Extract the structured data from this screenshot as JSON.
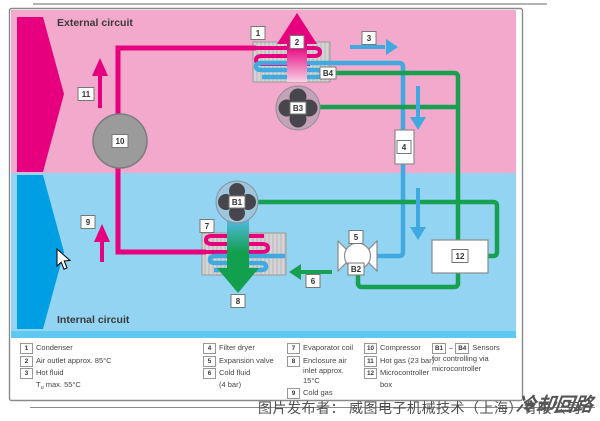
{
  "colors": {
    "magenta": "#E6007E",
    "pink_bg": "#F2A9CB",
    "dark_cyan": "#00A0E1",
    "blue_bg": "#92D4F2",
    "pipe_blue": "#3FA9E0",
    "green": "#17A04F",
    "component_gray": "#9B9B9B",
    "divider_cyan": "#5FC8F1"
  },
  "diagram": {
    "external_circuit": "External circuit",
    "internal_circuit": "Internal circuit",
    "labels": {
      "l1": "1",
      "l2": "2",
      "l3": "3",
      "l4": "4",
      "l5": "5",
      "l6": "6",
      "l7": "7",
      "l8": "8",
      "l9": "9",
      "l10": "10",
      "l11": "11",
      "l12": "12",
      "b1": "B1",
      "b2": "B2",
      "b3": "B3",
      "b4": "B4"
    }
  },
  "legend": {
    "c1": {
      "n1": "1",
      "t1": "Condenser",
      "n2": "2",
      "t2": "Air outlet approx. 85°C",
      "n3": "3",
      "t3": "Hot fluid",
      "t3b_T": "T",
      "t3b_u": "u",
      "t3b_rest": " max. 55°C"
    },
    "c2": {
      "n4": "4",
      "t4": "Filter dryer",
      "n5": "5",
      "t5": "Expansion valve",
      "n6": "6",
      "t6": "Cold fluid",
      "t6b": "(4 bar)"
    },
    "c3": {
      "n7": "7",
      "t7": "Evaporator coil",
      "n8": "8",
      "t8a": "Enclosure air",
      "t8b": "inlet approx.",
      "t8c": "15°C",
      "n9": "9",
      "t9": "Cold gas"
    },
    "c4": {
      "n10": "10",
      "t10": "Compressor",
      "n11": "11",
      "t11": "Hot gas (23 bar)",
      "n12": "12",
      "t12a": "Microcontroller",
      "t12b": "box"
    },
    "c5": {
      "b1": "B1",
      "dash": "–",
      "b4": "B4",
      "t": "Sensors",
      "l2": "for controlling via",
      "l3": "microcontroller"
    }
  },
  "footer": {
    "caption": "图片发布者： 威图电子机械技术（上海）有限公司",
    "watermark": "冷却回路"
  }
}
